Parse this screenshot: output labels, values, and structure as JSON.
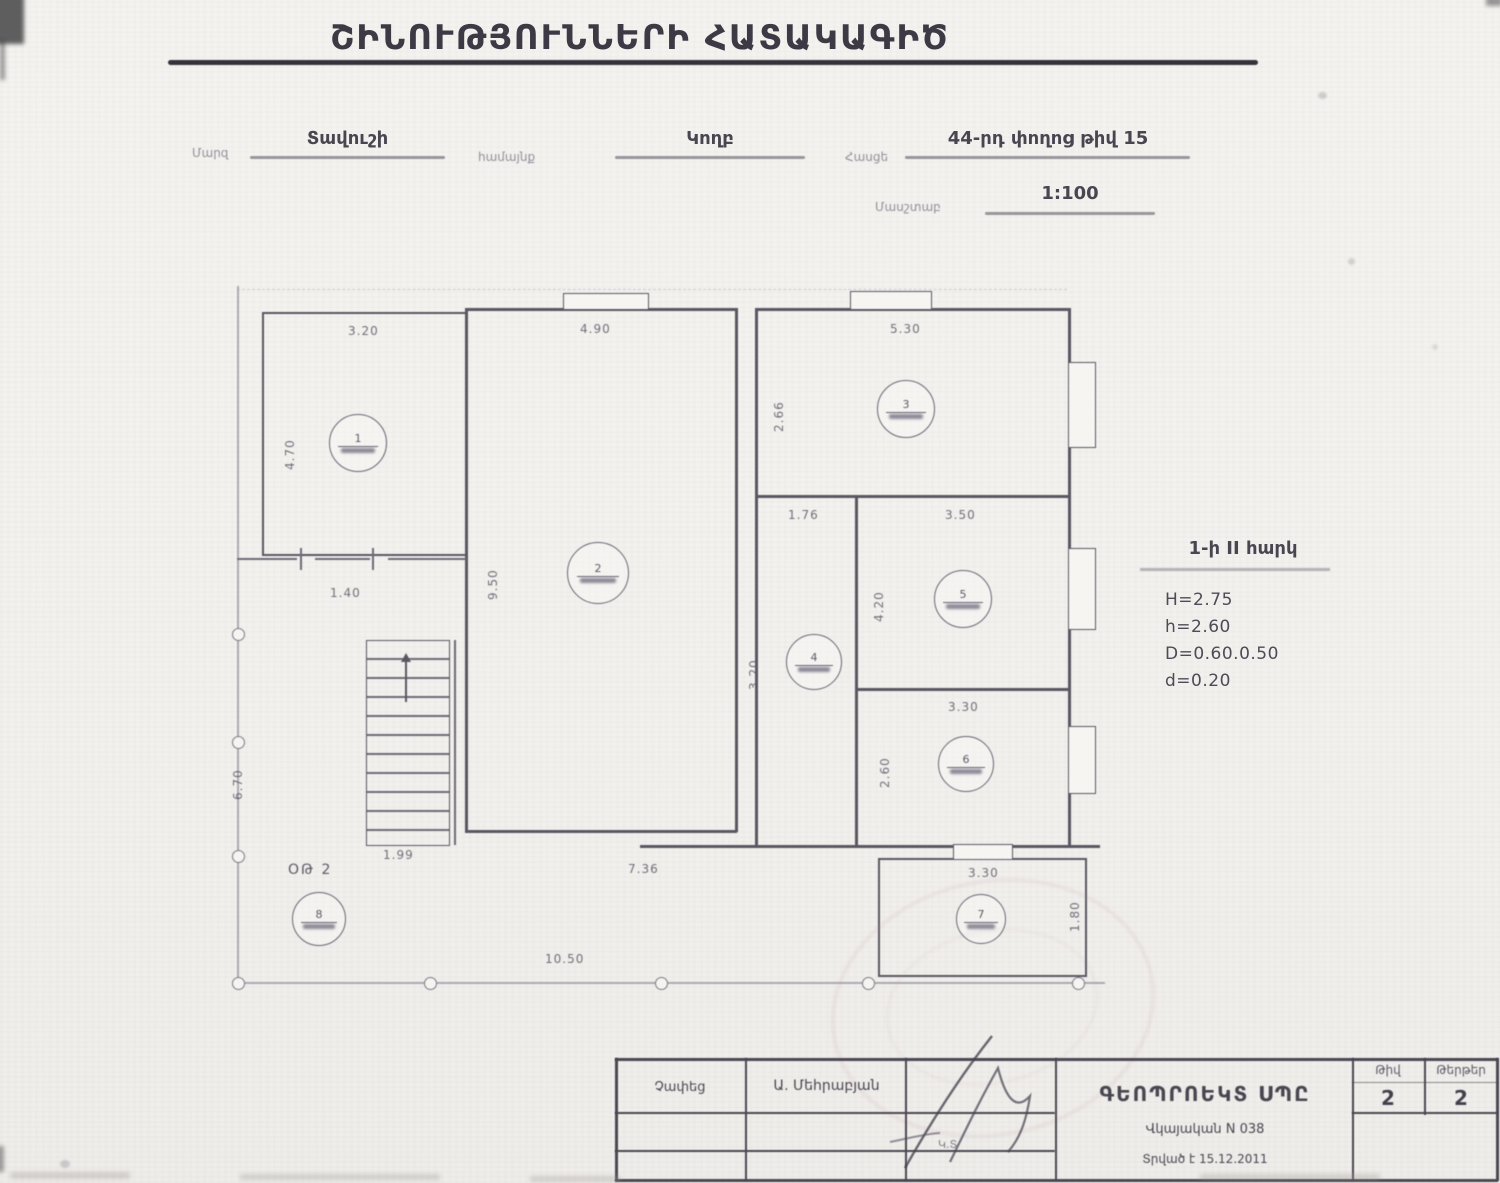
{
  "title": "ՇԻՆՈՒԹՅՈՒՆՆԵՐԻ ՀԱՏԱԿԱԳԻԾ",
  "header": {
    "region_label": "Մարզ",
    "region_value": "Տավուշի",
    "community_label": "համայնք",
    "community_value": "Կողբ",
    "address_label": "Հասցե",
    "address_value": "44-րդ փողոց թիվ 15",
    "scale_label": "Մասշտաբ",
    "scale_value": "1:100"
  },
  "notes": {
    "floor_title": "1-ի II հարկ",
    "line1": "H=2.75",
    "line2": "h=2.60",
    "line3": "D=0.60.0.50",
    "line4": "d=0.20"
  },
  "plan": {
    "annex_label": "ՕԹ 2",
    "rooms": [
      {
        "num": "1"
      },
      {
        "num": "2"
      },
      {
        "num": "3"
      },
      {
        "num": "4"
      },
      {
        "num": "5"
      },
      {
        "num": "6"
      },
      {
        "num": "7"
      },
      {
        "num": "8"
      }
    ],
    "dims": {
      "room1_w": "3.20",
      "room1_h": "4.70",
      "hall_w": "4.90",
      "hall_h": "9.50",
      "room3_w": "5.30",
      "room3_h": "2.66",
      "corridor_w": "1.76",
      "corridor_h": "3.20",
      "room4_w": "3.50",
      "room4_h": "4.20",
      "room5_w": "3.30",
      "room5_h": "2.60",
      "room6_w": "3.30",
      "room6_h": "1.80",
      "stair_w": "1.40",
      "stair_exit": "1.99",
      "hall_b": "7.36",
      "total_b": "10.50",
      "left_h": "6.70"
    }
  },
  "titleblock": {
    "measured_label": "Չափեց",
    "measured_by": "Ա. Մեհրաբյան",
    "company": "ԳԵՈՊՐՈԵԿՏ ՍՊԸ",
    "certificate": "Վկայական N 038",
    "issued": "Տրված է 15.12.2011",
    "num_label": "Թիվ",
    "num_value": "2",
    "sheets_label": "Թերթեր",
    "sheets_value": "2"
  }
}
